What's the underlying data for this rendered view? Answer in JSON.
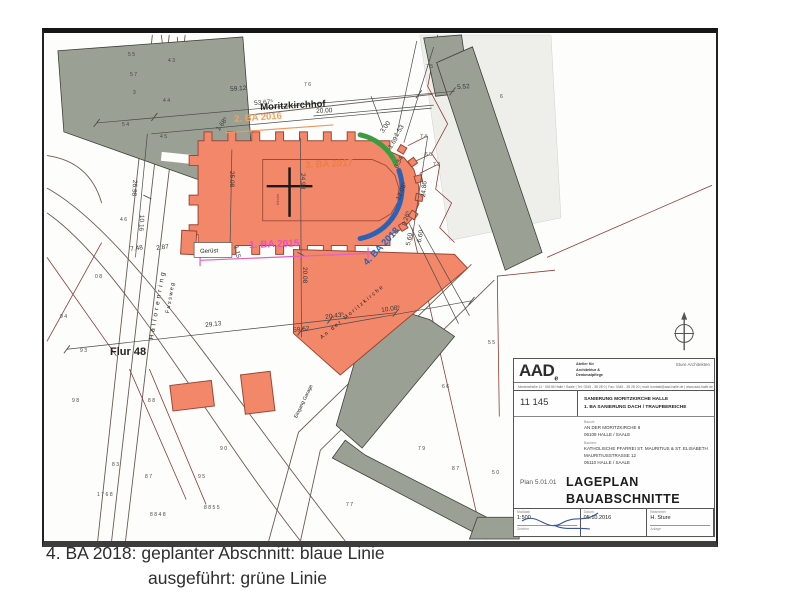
{
  "caption": {
    "line1": "4. BA 2018: geplanter Abschnitt: blaue Linie",
    "line2": "ausgeführt: grüne Linie"
  },
  "scan": {
    "labels": {
      "moritzkirchhof": "Moritzkirchhof",
      "ba2016": "2. BA 2016",
      "ba2017": "3. BA 2017",
      "ba2015": "1. BA 2015",
      "ba2018": "4. BA 2018",
      "geruest": "Gerüst",
      "flur": "Flur 48",
      "hallorenring": "Hallorenring",
      "fussweg": "Fussweg",
      "moritz_street": "An der Moritzkirche",
      "eingang": "Eingang Garage",
      "kirche": "Kirche"
    },
    "measurements": [
      "59.12",
      "5.52",
      "53.67⁵",
      "20.00",
      "26.98",
      "10.16",
      "7.48",
      "2.87",
      "25.08",
      "24.98",
      "20.08",
      "1.15",
      "29.13",
      "59.62",
      "20.43⁵",
      "10.08⁵",
      "3.00",
      "1.68⁵",
      "1.53",
      "1.69⁵",
      "6.34",
      "12.08⁵",
      "8.26⁵",
      "5.60",
      "6.60",
      "24.86"
    ],
    "parcels": [
      "55",
      "57",
      "3",
      "54",
      "43",
      "44",
      "45",
      "76",
      "75",
      "74",
      "65",
      "73",
      "6",
      "98",
      "88",
      "90",
      "83",
      "87",
      "1768",
      "95",
      "8848",
      "8855",
      "77",
      "79",
      "66",
      "55",
      "50",
      "87",
      "94",
      "93",
      "08",
      "46"
    ],
    "titleblock": {
      "logo": "AAD",
      "logo_sub": "e",
      "firm_line1": "Atelier für",
      "firm_line2": "Architektur &",
      "firm_line3": "Denkmalpflege",
      "firm_right": "Sture Architekten",
      "address": "Niederstraße 11 · 06108 Halle / Saale | Tel: 0345 - 38 28 0 | Fax: 0345 - 38 28 20 | mail: kontakt@aad-halle.de | www.aad-halle.de",
      "project_no": "11 145",
      "title_line1": "SANIERUNG MORITZKIRCHE HALLE",
      "title_line2": "1. BA SANIERUNG DACH / TRAUFBEREICHE",
      "bauort_label": "Bauort:",
      "bauort_line1": "AN DER MORITZKIRCHE 8",
      "bauort_line2": "06108 HALLE / SAALE",
      "bauherr_label": "Bauherr:",
      "bauherr_line1": "KATHOLISCHE PFARREI ST. MAURITIUS & ST. ELISABETH",
      "bauherr_line2": "MAURITIUSSTRASSE 12",
      "bauherr_line3": "06110 HALLE / SAALE",
      "plan_no": "Plan 5.01.01",
      "plan_title1": "LAGEPLAN",
      "plan_title2": "BAUABSCHNITTE",
      "masstab_label": "Maßstab",
      "masstab_value": "1:500",
      "datum_label": "Datum",
      "datum_value": "05.10.2016",
      "bearb_label": "Bearbeiter",
      "bearb_value": "H. Sture",
      "zeichen_label": "Zeichen",
      "anlage_label": "Anlage"
    },
    "colors": {
      "church_fill": "#f2876a",
      "planned_line": "#2a62b8",
      "executed_line": "#3c9c40",
      "ba2015": "#e84fc3",
      "ba2016": "#f2a05a",
      "ba2017": "#ef7f3f",
      "cadastral_red": "#8a3c34",
      "building_gray": "#9ba094"
    }
  }
}
